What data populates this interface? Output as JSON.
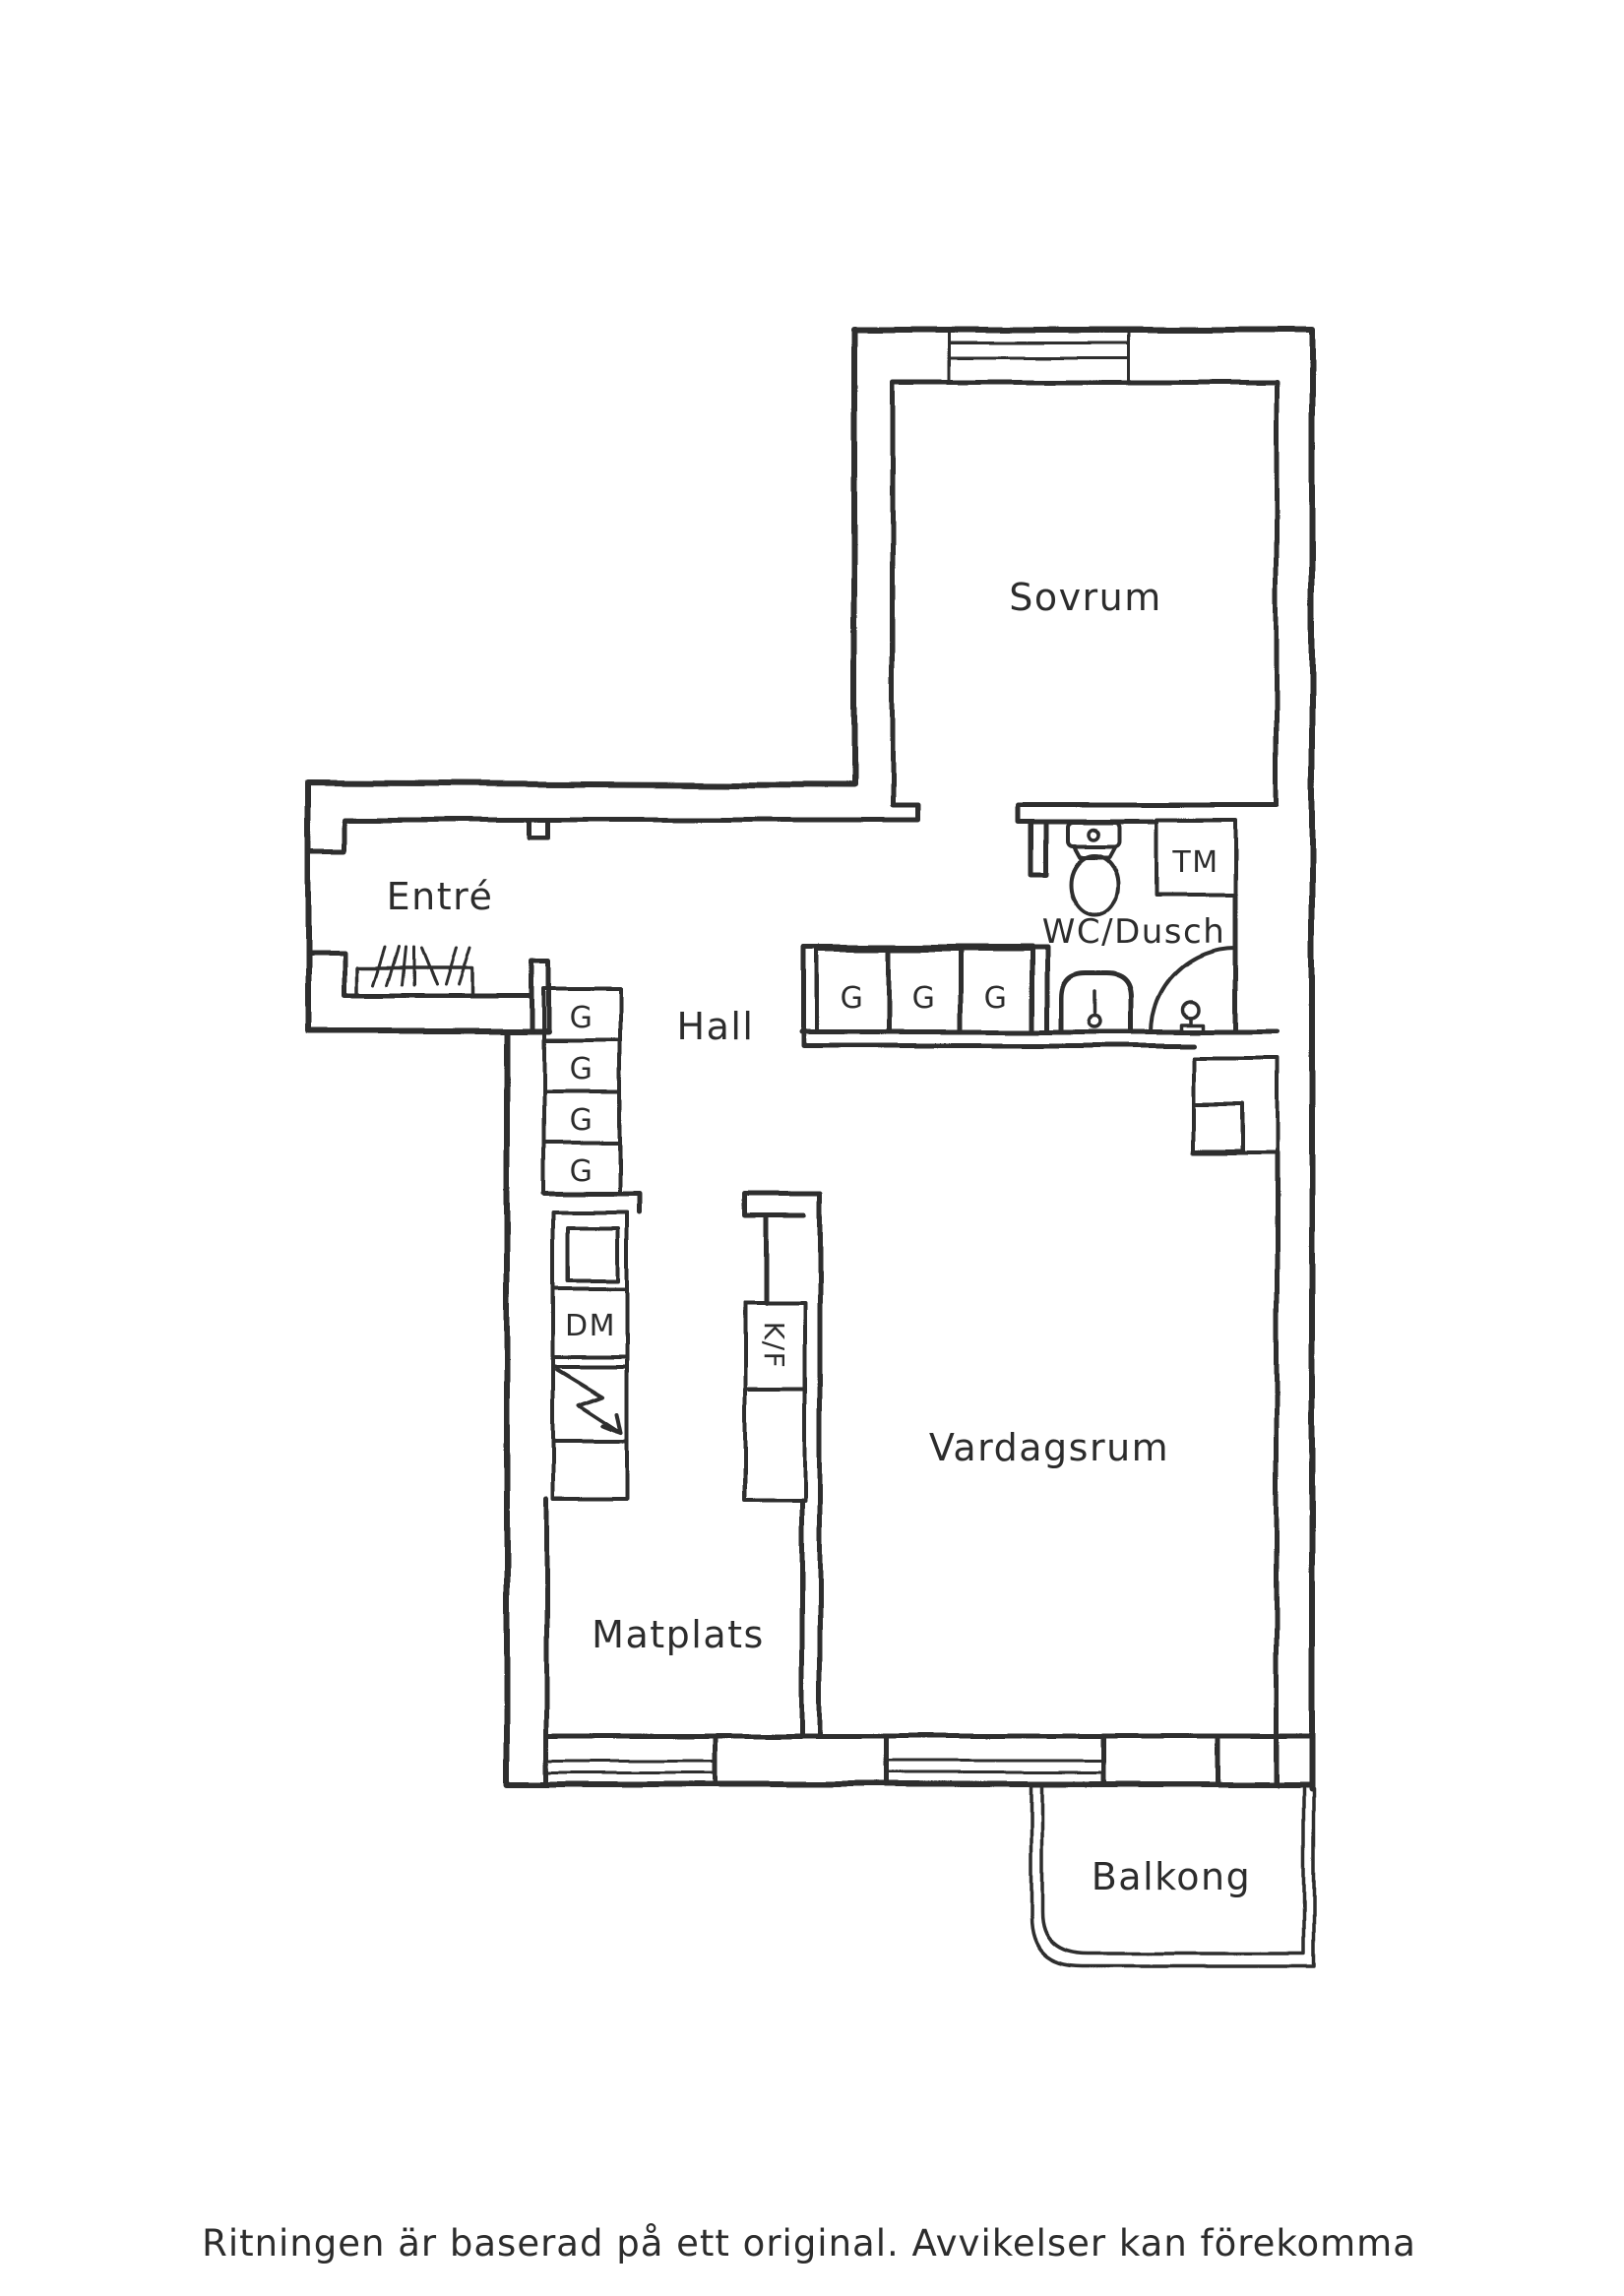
{
  "colors": {
    "ink": "#2d2d2d",
    "paper": "#ffffff"
  },
  "labels": {
    "sovrum": "Sovrum",
    "entre": "Entré",
    "hall": "Hall",
    "wc_dusch": "WC/Dusch",
    "vardagsrum": "Vardagsrum",
    "matplats": "Matplats",
    "balkong": "Balkong",
    "tm": "TM",
    "dm": "DM",
    "kf": "K/F"
  },
  "wardrobes": {
    "hall_row": [
      "G",
      "G",
      "G"
    ],
    "column": [
      "G",
      "G",
      "G",
      "G"
    ]
  },
  "footer": {
    "disclaimer": "Ritningen är baserad på ett original. Avvikelser kan förekomma"
  }
}
